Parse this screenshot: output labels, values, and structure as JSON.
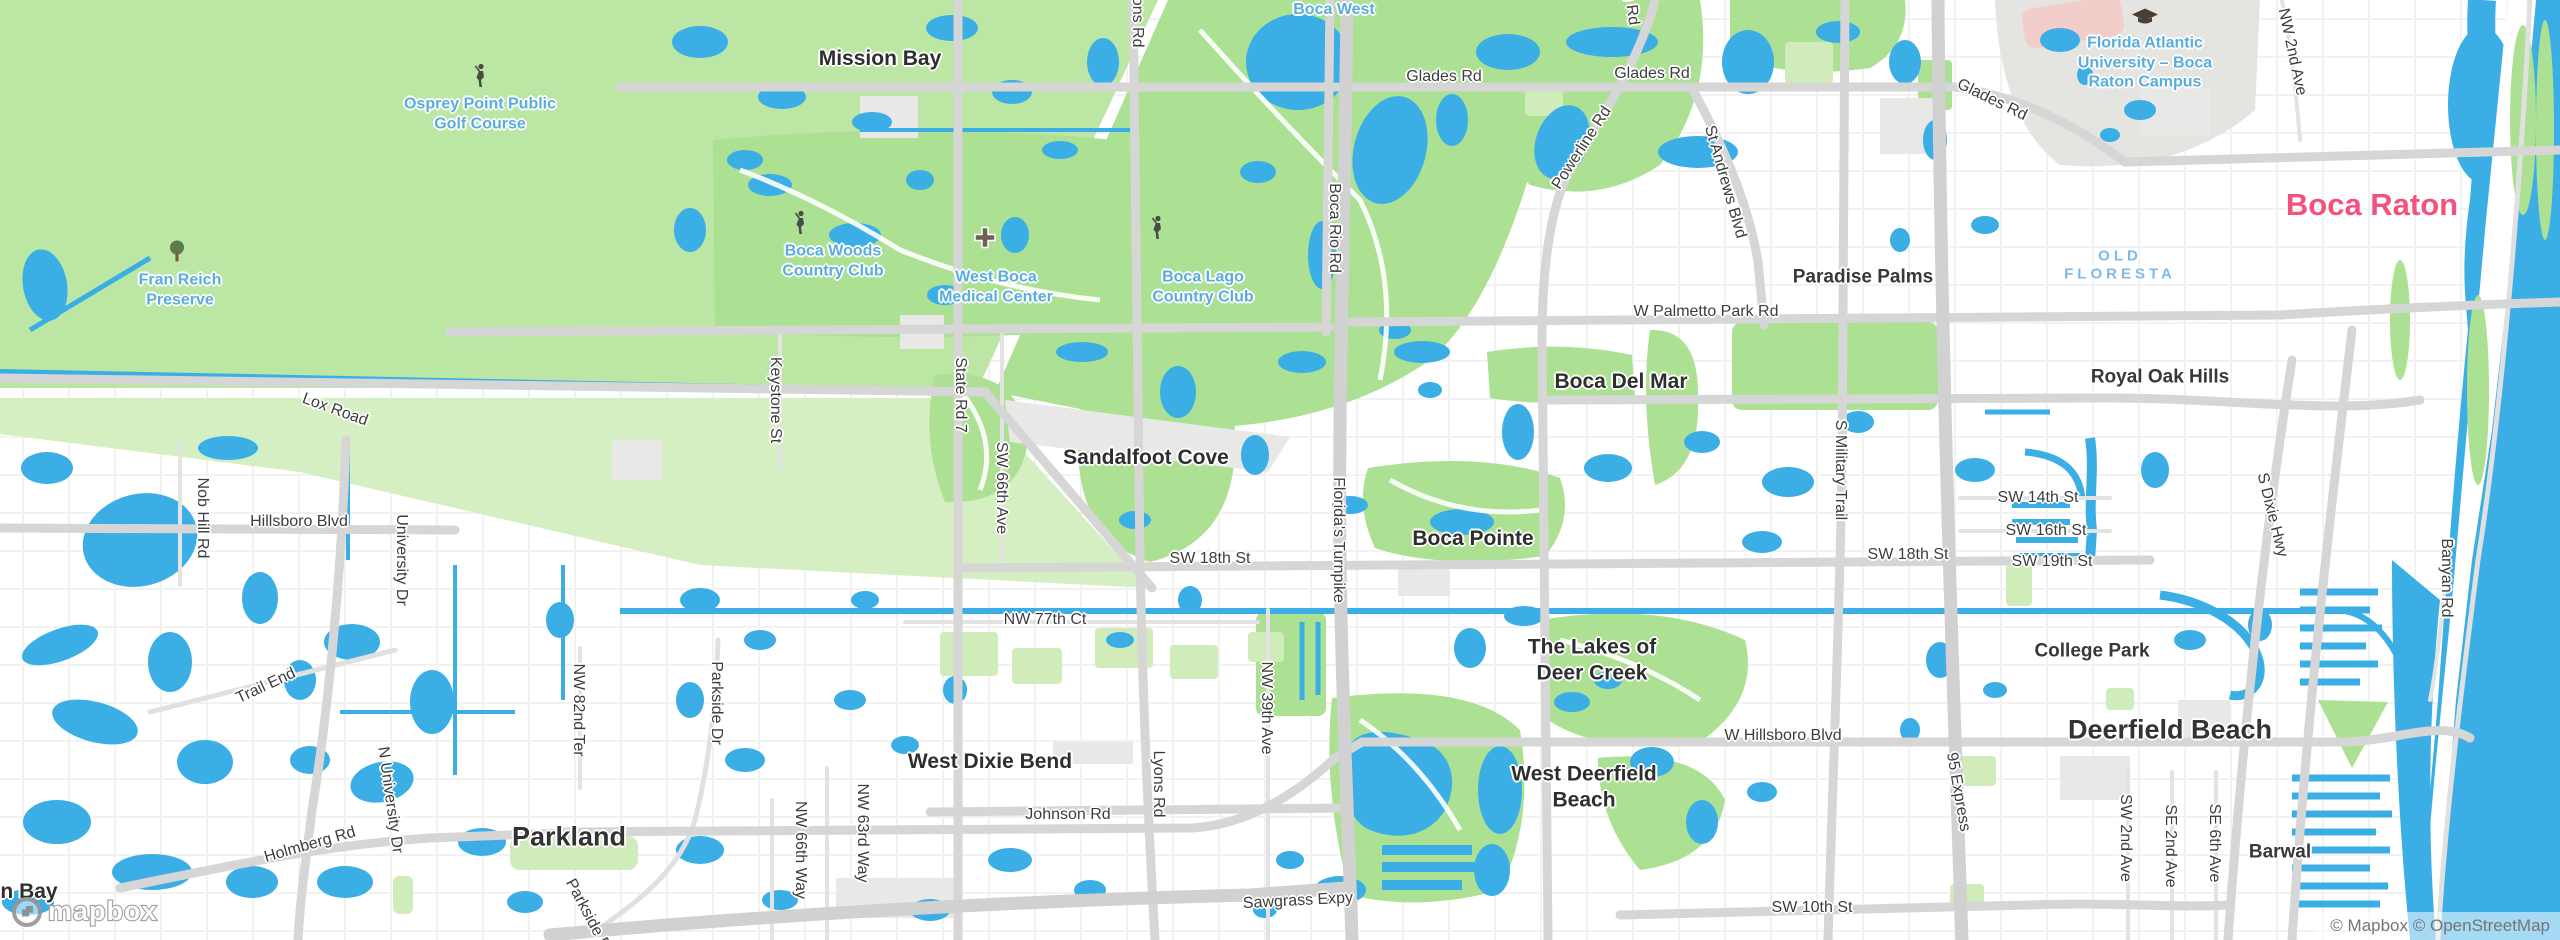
{
  "map": {
    "attribution": "© Mapbox © OpenStreetMap",
    "logo_text": "mapbox",
    "colors": {
      "land": "#FFFFFF",
      "water": "#3BAEE6",
      "park_green": "#ACE093",
      "park_light": "#CFECBA",
      "preserve_green": "#BCE6A3",
      "preserve_light": "#D5EFC2",
      "road_major": "#D6D6D6",
      "road_motorway": "#D1D1D1",
      "road_minor": "#EDEDED",
      "district_gray": "#E8E8E6",
      "campus_gray": "#E4E4E1",
      "stadium_pink": "#F3CDC9",
      "label_dark": "#333333",
      "label_road": "#3D3D3D",
      "label_park": "#58ACDE",
      "hood_blue": "#7FB9E6",
      "city_pink": "#F2527E",
      "attr": "#757575"
    },
    "labels": [
      {
        "text": "Boca Raton",
        "x": 2372,
        "y": 205,
        "rot": 0,
        "cls": "city-pink"
      },
      {
        "text": "Deerfield Beach",
        "x": 2170,
        "y": 730,
        "rot": 0,
        "cls": "city"
      },
      {
        "text": "Parkland",
        "x": 569,
        "y": 837,
        "rot": 0,
        "cls": "city"
      },
      {
        "text": "Mission Bay",
        "x": 880,
        "y": 59,
        "rot": 0,
        "cls": "town"
      },
      {
        "text": "Sandalfoot Cove",
        "x": 1146,
        "y": 458,
        "rot": 0,
        "cls": "town"
      },
      {
        "text": "Boca Del Mar",
        "x": 1621,
        "y": 382,
        "rot": 0,
        "cls": "town"
      },
      {
        "text": "Boca Pointe",
        "x": 1473,
        "y": 539,
        "rot": 0,
        "cls": "town"
      },
      {
        "text": "West Dixie Bend",
        "x": 990,
        "y": 762,
        "rot": 0,
        "cls": "town"
      },
      {
        "text": "West Deerfield\nBeach",
        "x": 1584,
        "y": 787,
        "rot": 0,
        "cls": "town"
      },
      {
        "text": "The Lakes of\nDeer Creek",
        "x": 1592,
        "y": 660,
        "rot": 0,
        "cls": "town"
      },
      {
        "text": "n Bay",
        "x": 29,
        "y": 892,
        "rot": 0,
        "cls": "town"
      },
      {
        "text": "Paradise Palms",
        "x": 1863,
        "y": 277,
        "rot": 0,
        "cls": "hood"
      },
      {
        "text": "Royal Oak Hills",
        "x": 2160,
        "y": 377,
        "rot": 0,
        "cls": "hood"
      },
      {
        "text": "College Park",
        "x": 2092,
        "y": 651,
        "rot": 0,
        "cls": "hood"
      },
      {
        "text": "Barwal",
        "x": 2280,
        "y": 852,
        "rot": 0,
        "cls": "hood"
      },
      {
        "text": "OLD\nFLORESTA",
        "x": 2120,
        "y": 266,
        "rot": 0,
        "cls": "hood-blue"
      },
      {
        "text": "Osprey Point Public\nGolf Course",
        "x": 480,
        "y": 114,
        "rot": 0,
        "cls": "park"
      },
      {
        "text": "Fran Reich\nPreserve",
        "x": 180,
        "y": 290,
        "rot": 0,
        "cls": "park"
      },
      {
        "text": "Boca Woods\nCountry Club",
        "x": 833,
        "y": 261,
        "rot": 0,
        "cls": "park"
      },
      {
        "text": "Boca Lago\nCountry Club",
        "x": 1203,
        "y": 287,
        "rot": 0,
        "cls": "park"
      },
      {
        "text": "Boca West",
        "x": 1334,
        "y": 10,
        "rot": 0,
        "cls": "park"
      },
      {
        "text": "West Boca\nMedical Center",
        "x": 996,
        "y": 287,
        "rot": 0,
        "cls": "park"
      },
      {
        "text": "Florida Atlantic\nUniversity – Boca\nRaton Campus",
        "x": 2145,
        "y": 63,
        "rot": 0,
        "cls": "park"
      },
      {
        "text": "Glades Rd",
        "x": 1444,
        "y": 77,
        "rot": 0,
        "cls": "road"
      },
      {
        "text": "Glades Rd",
        "x": 1652,
        "y": 74,
        "rot": 0,
        "cls": "road"
      },
      {
        "text": "Glades Rd",
        "x": 1992,
        "y": 100,
        "rot": 26,
        "cls": "road"
      },
      {
        "text": "W Palmetto Park Rd",
        "x": 1706,
        "y": 312,
        "rot": 0,
        "cls": "road"
      },
      {
        "text": "SW 18th St",
        "x": 1210,
        "y": 559,
        "rot": 0,
        "cls": "road"
      },
      {
        "text": "SW 18th St",
        "x": 1908,
        "y": 555,
        "rot": 0,
        "cls": "road"
      },
      {
        "text": "SW 14th St",
        "x": 2038,
        "y": 498,
        "rot": 0,
        "cls": "road"
      },
      {
        "text": "SW 16th St",
        "x": 2046,
        "y": 531,
        "rot": 0,
        "cls": "road"
      },
      {
        "text": "SW 19th St",
        "x": 2052,
        "y": 562,
        "rot": 0,
        "cls": "road"
      },
      {
        "text": "NW 77th Ct",
        "x": 1045,
        "y": 620,
        "rot": 0,
        "cls": "road"
      },
      {
        "text": "W Hillsboro Blvd",
        "x": 1783,
        "y": 736,
        "rot": 0,
        "cls": "road"
      },
      {
        "text": "SW 10th St",
        "x": 1812,
        "y": 908,
        "rot": 0,
        "cls": "road"
      },
      {
        "text": "Sawgrass Expy",
        "x": 1298,
        "y": 901,
        "rot": -3,
        "cls": "road"
      },
      {
        "text": "Johnson Rd",
        "x": 1068,
        "y": 815,
        "rot": 0,
        "cls": "road"
      },
      {
        "text": "Hillsboro Blvd",
        "x": 299,
        "y": 522,
        "rot": 0,
        "cls": "road"
      },
      {
        "text": "Lox Road",
        "x": 335,
        "y": 410,
        "rot": 20,
        "cls": "road"
      },
      {
        "text": "Trail End",
        "x": 266,
        "y": 686,
        "rot": -25,
        "cls": "road"
      },
      {
        "text": "Holmberg Rd",
        "x": 310,
        "y": 845,
        "rot": -16,
        "cls": "road"
      },
      {
        "text": "NW 2nd Ave",
        "x": 2292,
        "y": 52,
        "rot": 78,
        "cls": "road"
      },
      {
        "text": "Powerline Rd",
        "x": 1582,
        "y": 148,
        "rot": -57,
        "cls": "road"
      },
      {
        "text": "St Andrews Blvd",
        "x": 1725,
        "y": 182,
        "rot": 74,
        "cls": "road"
      },
      {
        "text": "S Dixie Hwy",
        "x": 2272,
        "y": 515,
        "rot": 76,
        "cls": "road"
      },
      {
        "text": "95 Express",
        "x": 1958,
        "y": 792,
        "rot": 80,
        "cls": "road"
      },
      {
        "text": "N University Dr",
        "x": 390,
        "y": 800,
        "rot": 82,
        "cls": "road"
      },
      {
        "text": "Boca Rio Rd",
        "x": 1334,
        "y": 228,
        "rot": 90,
        "cls": "road"
      },
      {
        "text": "Florida's Turnpike",
        "x": 1338,
        "y": 540,
        "rot": 90,
        "cls": "road"
      },
      {
        "text": "S Military Trail",
        "x": 1840,
        "y": 470,
        "rot": 90,
        "cls": "road"
      },
      {
        "text": "Lyons Rd",
        "x": 1158,
        "y": 784,
        "rot": 90,
        "cls": "road"
      },
      {
        "text": "Lyons Rd",
        "x": 1137,
        "y": 14,
        "rot": 90,
        "cls": "road"
      },
      {
        "text": "Jog Rd",
        "x": 1630,
        "y": 0,
        "rot": 82,
        "cls": "road"
      },
      {
        "text": "State Rd 7",
        "x": 960,
        "y": 395,
        "rot": 90,
        "cls": "road"
      },
      {
        "text": "SW 66th Ave",
        "x": 1001,
        "y": 488,
        "rot": 90,
        "cls": "road"
      },
      {
        "text": "Keystone St",
        "x": 775,
        "y": 400,
        "rot": 90,
        "cls": "road"
      },
      {
        "text": "NW 39th Ave",
        "x": 1266,
        "y": 708,
        "rot": 90,
        "cls": "road"
      },
      {
        "text": "NW 82nd Ter",
        "x": 578,
        "y": 710,
        "rot": 90,
        "cls": "road"
      },
      {
        "text": "Parkside Dr",
        "x": 716,
        "y": 703,
        "rot": 90,
        "cls": "road"
      },
      {
        "text": "Parkside Dr",
        "x": 589,
        "y": 917,
        "rot": 62,
        "cls": "road"
      },
      {
        "text": "NW 66th Way",
        "x": 800,
        "y": 850,
        "rot": 90,
        "cls": "road"
      },
      {
        "text": "NW 63rd Way",
        "x": 862,
        "y": 833,
        "rot": 90,
        "cls": "road"
      },
      {
        "text": "University Dr",
        "x": 401,
        "y": 560,
        "rot": 90,
        "cls": "road"
      },
      {
        "text": "Nob Hill Rd",
        "x": 202,
        "y": 518,
        "rot": 90,
        "cls": "road"
      },
      {
        "text": "SW 2nd Ave",
        "x": 2125,
        "y": 838,
        "rot": 90,
        "cls": "road"
      },
      {
        "text": "SE 2nd Ave",
        "x": 2170,
        "y": 846,
        "rot": 90,
        "cls": "road"
      },
      {
        "text": "SE 6th Ave",
        "x": 2214,
        "y": 843,
        "rot": 90,
        "cls": "road"
      },
      {
        "text": "Banyan Rd",
        "x": 2446,
        "y": 578,
        "rot": 90,
        "cls": "road"
      }
    ],
    "icons": [
      {
        "name": "golfer-icon",
        "x": 480,
        "y": 78
      },
      {
        "name": "golfer-icon",
        "x": 800,
        "y": 225
      },
      {
        "name": "golfer-icon",
        "x": 1157,
        "y": 230
      },
      {
        "name": "tree-icon",
        "x": 177,
        "y": 254
      },
      {
        "name": "hospital-icon",
        "x": 985,
        "y": 240
      },
      {
        "name": "graduation-cap-icon",
        "x": 2145,
        "y": 20
      }
    ]
  }
}
